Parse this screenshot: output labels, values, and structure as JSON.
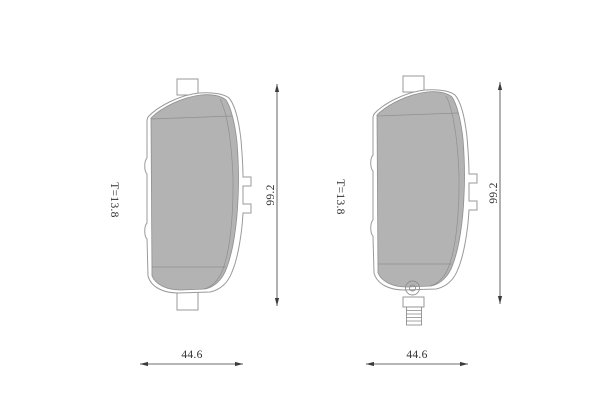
{
  "colors": {
    "background": "#ffffff",
    "pad_fill": "#b3b3b3",
    "outline": "#9a9a9a",
    "dimension": "#3c3c3c",
    "label_text": "#2e2e2e"
  },
  "pads": [
    {
      "thickness_label": "T=13.8",
      "height_label": "99.2",
      "width_label": "44.6"
    },
    {
      "thickness_label": "T=13.8",
      "height_label": "99.2",
      "width_label": "44.6"
    }
  ]
}
